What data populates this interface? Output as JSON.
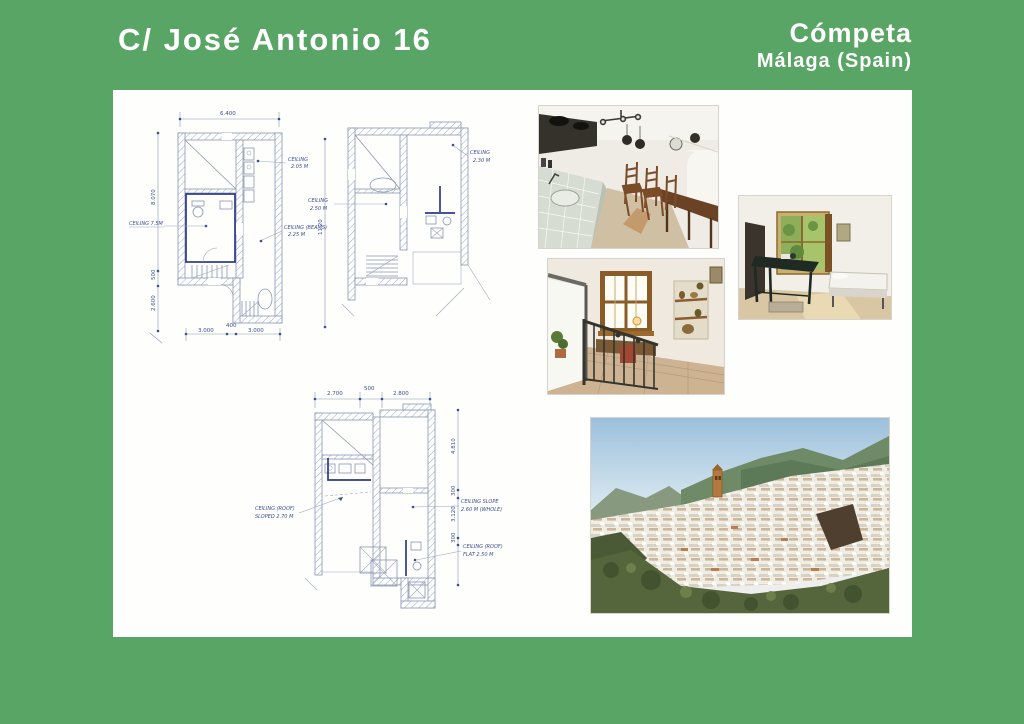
{
  "header": {
    "title": "C/ José Antonio 16",
    "town": "Cómpeta",
    "region": "Málaga (Spain)"
  },
  "colors": {
    "frame_green": "#58a565",
    "plan_ink": "#8a95b2",
    "plan_accent_navy": "#2b3a8c",
    "annotation_blue": "#3c4c96"
  },
  "plans": [
    {
      "name": "floor-plan-ground",
      "dim_top": "6.400",
      "dims_left": [
        "8.070",
        "500",
        "2.600"
      ],
      "dim_right": "11.20",
      "dims_bottom": [
        "3.000",
        "400",
        "3.000"
      ],
      "annotations": [
        {
          "l1": "CEILING 7.5M",
          "l2": ""
        },
        {
          "l1": "CEILING",
          "l2": "2.05 M"
        },
        {
          "l1": "CEILING (BEAMS)",
          "l2": "2.25 M"
        }
      ]
    },
    {
      "name": "floor-plan-first",
      "annotations": [
        {
          "l1": "CEILING",
          "l2": "2.50 M"
        },
        {
          "l1": "CEILING",
          "l2": "2.30 M"
        }
      ]
    },
    {
      "name": "floor-plan-top",
      "dims_top": [
        "2.700",
        "500",
        "2.800"
      ],
      "dims_right": [
        "4.810",
        "300",
        "3.120",
        "300"
      ],
      "annotations": [
        {
          "l1": "CEILING (ROOF)",
          "l2": "SLOPED 2.70 M"
        },
        {
          "l1": "CEILING SLOPE",
          "l2": "2.60 M (WHOLE)"
        },
        {
          "l1": "CEILING (ROOF)",
          "l2": "FLAT 2.50 M"
        }
      ]
    }
  ],
  "photos": [
    {
      "name": "kitchen-dining-photo"
    },
    {
      "name": "bedroom-photo"
    },
    {
      "name": "stair-landing-photo"
    },
    {
      "name": "village-panorama-photo"
    }
  ]
}
